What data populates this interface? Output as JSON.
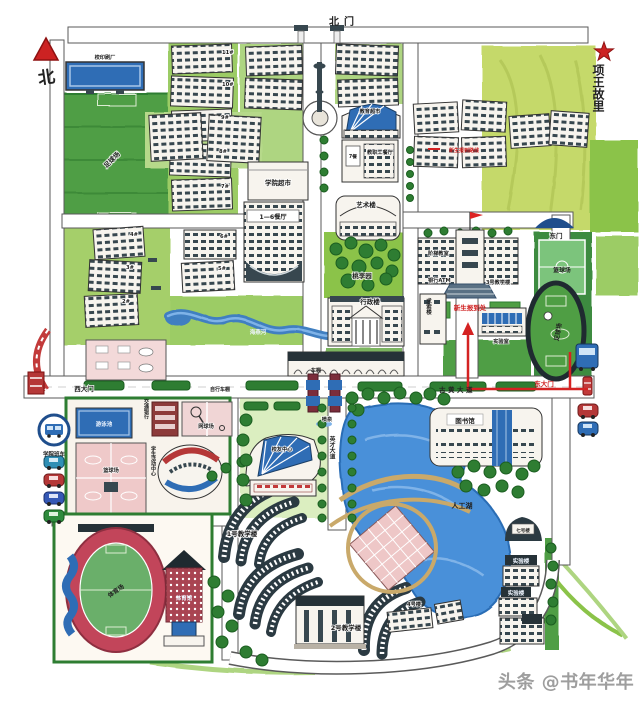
{
  "map_title": "手绘校园地图",
  "colors": {
    "accent_red": "#cc2222",
    "water_blue": "#3f7fc1",
    "lake_blue": "#4a90d9",
    "field_green": "#4f9e44",
    "tree_green": "#2e7d32",
    "track_red": "#c2455a",
    "court_pink": "#efc9c9",
    "road_outline": "#5a5a5a"
  },
  "compass": {
    "north_char": "北"
  },
  "landmark": {
    "star_label": "项王故里"
  },
  "gates": {
    "north": "北门",
    "west": "西大门",
    "east_north": "东门",
    "east_main": "东大门"
  },
  "roads": {
    "guhuang": "古黄大道",
    "yingcai": "英才大道"
  },
  "route": {
    "legend": "新生报到路线",
    "registration": "新生报到处"
  },
  "labels": {
    "print_factory": "校印刷厂",
    "football_left": "足球场",
    "d11": "11#",
    "d10": "10#",
    "d9": "9#",
    "d8": "8#",
    "d7": "7#",
    "d6": "6#",
    "d5": "5#",
    "d4": "4#",
    "d3": "3#",
    "d2": "2#",
    "college_market": "学院超市",
    "canteen16": "1—6餐厅",
    "edu_market": "教育超市",
    "canteen7": "7餐",
    "staff_canteen": "教职工餐厅",
    "art": "艺术楼",
    "taoli": "桃李园",
    "admin": "行政楼",
    "lecture": "阶梯教室",
    "atm": "银行ATM",
    "teach3": "3号教学楼",
    "qiusuo": "求索楼",
    "lab_small": "实验室",
    "basketball_r": "篮球场",
    "football_r": "足球场",
    "bikeshed1": "自行车棚",
    "bikeshed2": "车棚",
    "shuttle": "学院班车",
    "pool": "游泳池",
    "basketball_l": "篮球场",
    "tennis": "网球场",
    "bank": "交通银行",
    "activity": "学生活动中心",
    "stadium": "体育场",
    "gym": "体育馆",
    "alumni": "校友中心",
    "fountain": "喷泉",
    "haiyan": "海燕河",
    "teach1": "1号教学楼",
    "teach2": "2号教学楼",
    "bldg4": "4号楼",
    "lake": "人工湖",
    "library": "图书馆",
    "b7": "七号楼",
    "lab1": "实验楼",
    "lab2": "实验楼"
  },
  "watermark": "头条 @书年华年"
}
